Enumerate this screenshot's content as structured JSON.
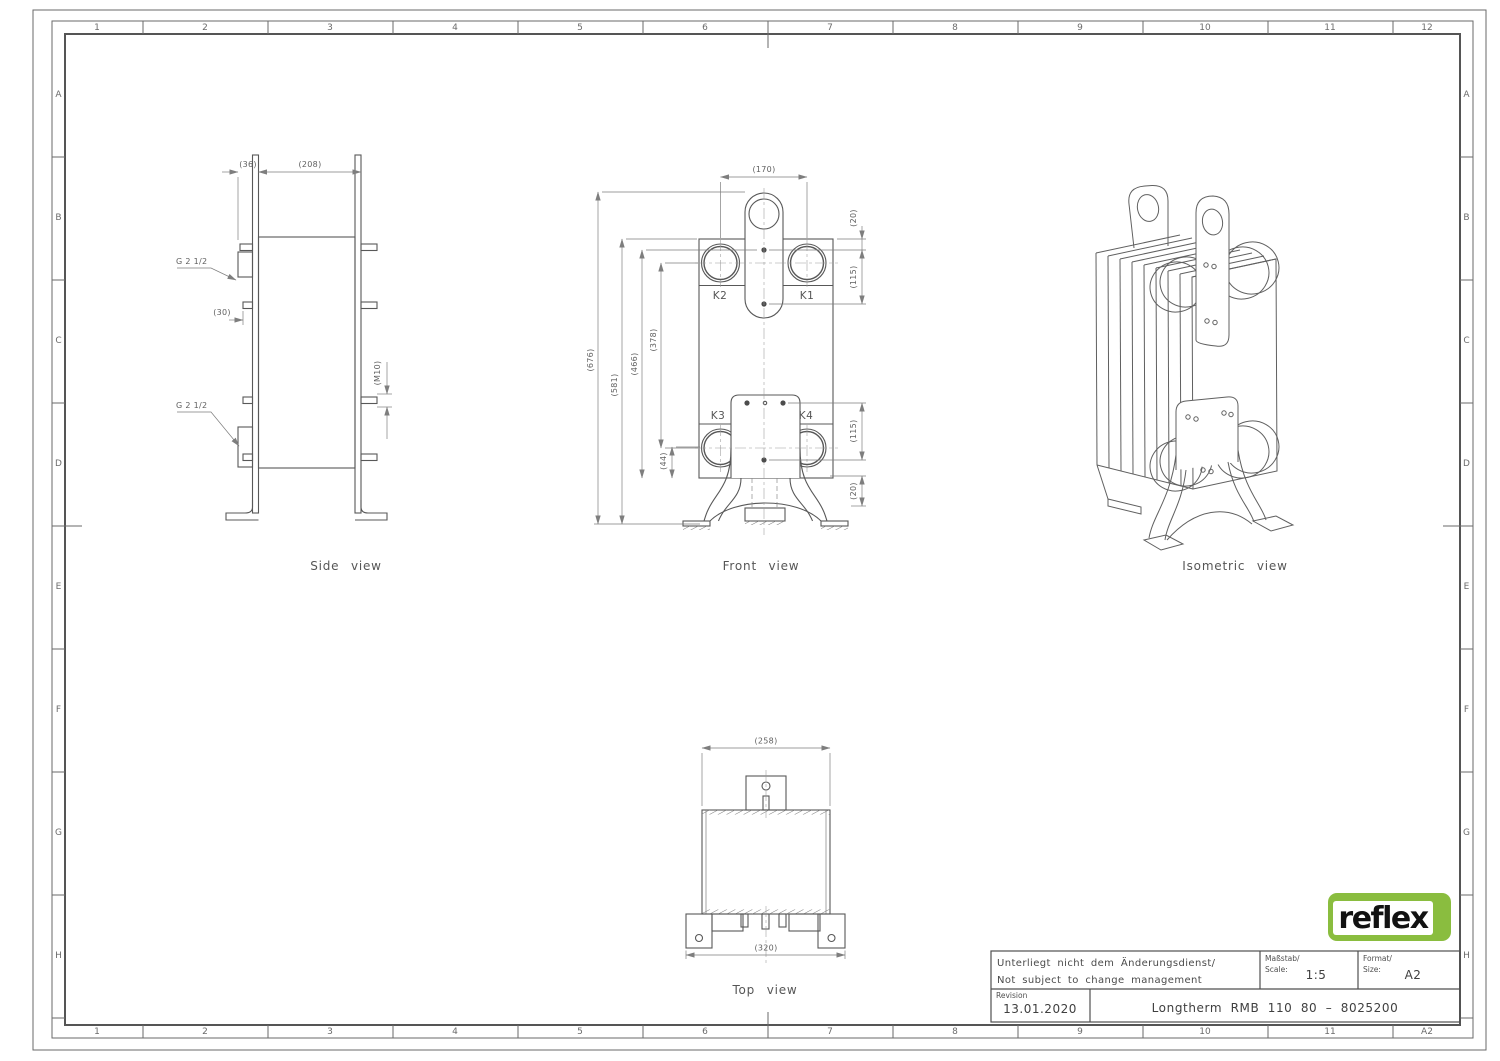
{
  "sheet": {
    "columns": [
      "1",
      "2",
      "3",
      "4",
      "5",
      "6",
      "7",
      "8",
      "9",
      "10",
      "11",
      "12"
    ],
    "columns_bottom": [
      "1",
      "2",
      "3",
      "4",
      "5",
      "6",
      "7",
      "8",
      "9",
      "10",
      "11",
      "A2"
    ],
    "rows_left": [
      "A",
      "B",
      "C",
      "D",
      "E",
      "F",
      "G",
      "H"
    ],
    "rows_right": [
      "A",
      "B",
      "C",
      "D",
      "E",
      "F",
      "G",
      "H"
    ]
  },
  "side_view": {
    "caption": "Side view",
    "dim_36": "(36)",
    "dim_208": "(208)",
    "dim_30": "(30)",
    "dim_m10": "(M10)",
    "port_label_top": "G 2 1/2",
    "port_label_bottom": "G 2 1/2"
  },
  "front_view": {
    "caption": "Front view",
    "port_k1": "K1",
    "port_k2": "K2",
    "port_k3": "K3",
    "port_k4": "K4",
    "dim_170": "(170)",
    "dim_676": "(676)",
    "dim_581": "(581)",
    "dim_466": "(466)",
    "dim_378": "(378)",
    "dim_44": "(44)",
    "dim_20_top": "(20)",
    "dim_115_top": "(115)",
    "dim_115_bottom": "(115)",
    "dim_20_bottom": "(20)"
  },
  "top_view": {
    "caption": "Top view",
    "dim_258": "(258)",
    "dim_320": "(320)"
  },
  "isometric_view": {
    "caption": "Isometric view"
  },
  "title_block": {
    "note_de": "Unterliegt nicht dem Änderungsdienst/",
    "note_en": "Not subject to change management",
    "scale_label_de": "Maßstab/",
    "scale_label_en": "Scale:",
    "scale_value": "1:5",
    "format_label_de": "Format/",
    "format_label_en": "Size:",
    "format_value": "A2",
    "revision_label": "Revision",
    "revision_date": "13.01.2020",
    "drawing_title": "Longtherm RMB 110 80 – 8025200"
  },
  "logo": {
    "brand": "reflex"
  },
  "colors": {
    "line": "#585858",
    "dim_line": "#7e7e7e",
    "text": "#5a5a5a",
    "logo_green": "#8abd3f",
    "logo_text": "#121212",
    "paper": "#ffffff"
  }
}
